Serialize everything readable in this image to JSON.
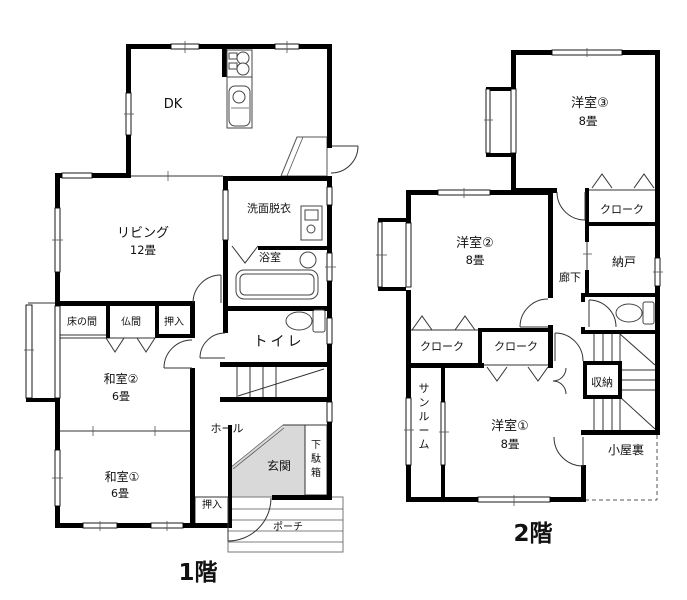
{
  "colors": {
    "wall": "#000000",
    "genkan_fill": "#d9d9d9"
  },
  "floor1": {
    "title": "1階",
    "rooms": {
      "dk": "DK",
      "living": "リビング",
      "living_size": "12畳",
      "washroom": "洗面脱衣",
      "bath": "浴室",
      "toilet": "トイレ",
      "tokonoma": "床の間",
      "butsuma": "仏間",
      "oshiire_top": "押入",
      "washitsu2": "和室②",
      "washitsu2_size": "6畳",
      "washitsu1": "和室①",
      "washitsu1_size": "6畳",
      "oshiire_bottom": "押入",
      "hall": "ホール",
      "genkan": "玄関",
      "getabako": "下駄箱",
      "porch": "ポーチ"
    }
  },
  "floor2": {
    "title": "2階",
    "rooms": {
      "yoshitsu3": "洋室③",
      "yoshitsu3_size": "8畳",
      "cloak_top": "クローク",
      "nando": "納戸",
      "roka": "廊下",
      "yoshitsu2": "洋室②",
      "yoshitsu2_size": "8畳",
      "cloak_left": "クローク",
      "cloak_right": "クローク",
      "shuno": "収納",
      "sunroom": "サンルーム",
      "yoshitsu1": "洋室①",
      "yoshitsu1_size": "8畳",
      "koyaura": "小屋裏"
    }
  }
}
